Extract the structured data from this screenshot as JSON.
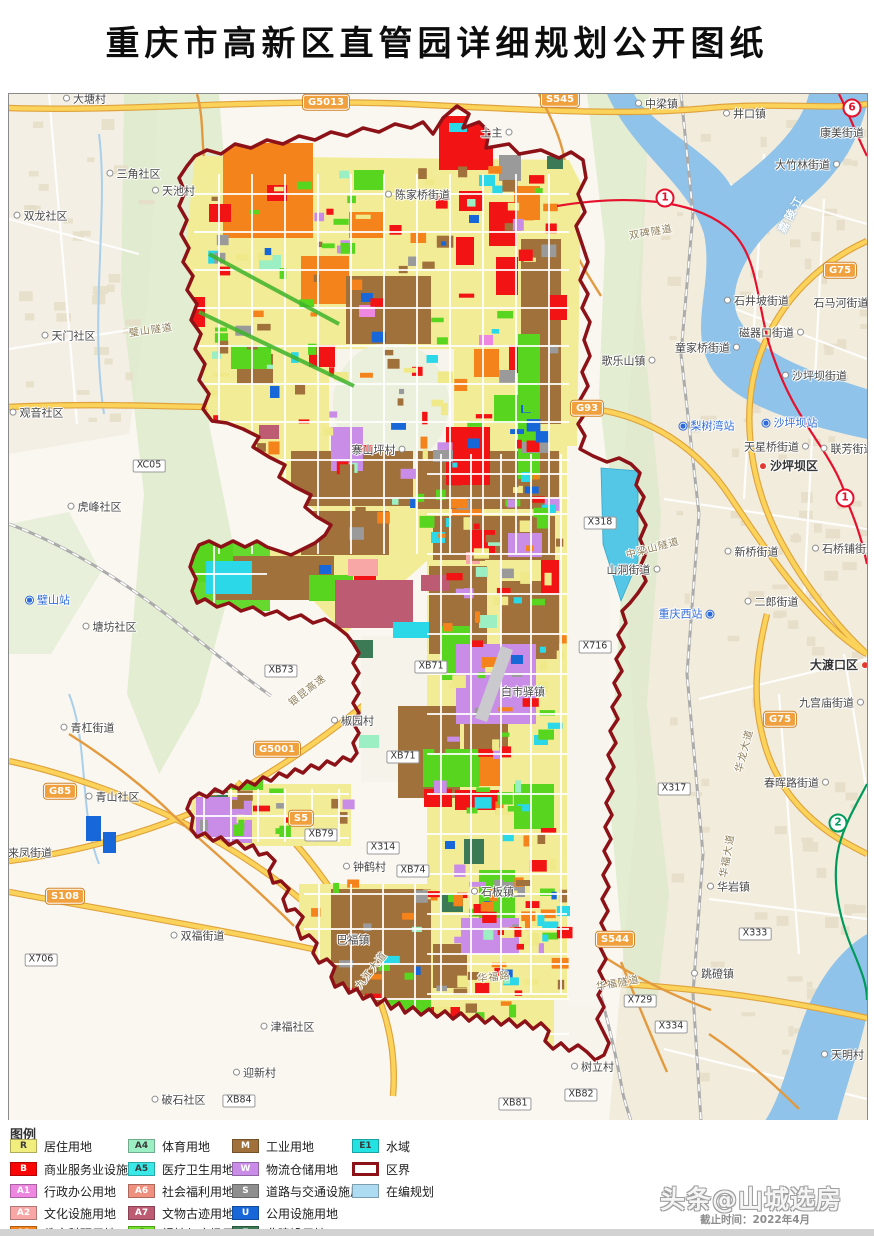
{
  "header": {
    "title": "重庆市高新区直管园详细规划公开图纸"
  },
  "watermark": {
    "line1": "头条@山城选房",
    "line2": "截止时间：2022年4月"
  },
  "legend": {
    "title": "图例",
    "columns": [
      [
        {
          "code": "R",
          "color": "#F1EE7D",
          "label": "居住用地"
        },
        {
          "code": "B",
          "color": "#FA0505",
          "label": "商业服务业设施用地"
        },
        {
          "code": "A1",
          "color": "#EE87E0",
          "label": "行政办公用地"
        },
        {
          "code": "A2",
          "color": "#F9A6A6",
          "label": "文化设施用地"
        },
        {
          "code": "A3",
          "color": "#F5831B",
          "label": "教育科研用地"
        }
      ],
      [
        {
          "code": "A4",
          "color": "#9BEFC3",
          "label": "体育用地"
        },
        {
          "code": "A5",
          "color": "#3BE8E8",
          "label": "医疗卫生用地"
        },
        {
          "code": "A6",
          "color": "#F0907E",
          "label": "社会福利用地"
        },
        {
          "code": "A7",
          "color": "#BC5B72",
          "label": "文物古迹用地"
        },
        {
          "code": "G",
          "color": "#6EE025",
          "label": "绿地与广场用地"
        }
      ],
      [
        {
          "code": "M",
          "color": "#A0713B",
          "label": "工业用地"
        },
        {
          "code": "W",
          "color": "#C98DE8",
          "label": "物流仓储用地"
        },
        {
          "code": "S",
          "color": "#8F8F8F",
          "label": "道路与交通设施用地"
        },
        {
          "code": "U",
          "color": "#1767D9",
          "label": "公用设施用地"
        },
        {
          "code": "E",
          "color": "#3C7A55",
          "label": "非建设用地"
        }
      ],
      [
        {
          "code": "E1",
          "color": "#25E2E2",
          "label": "水域"
        },
        {
          "code": "",
          "color": "#FFFFFF",
          "label": "区界",
          "type": "outline"
        },
        {
          "code": "",
          "color": "#ADDCF2",
          "label": "在编规划",
          "type": "plain"
        }
      ]
    ]
  },
  "map": {
    "boundary_color": "#8C1218",
    "places": [
      {
        "t": "大塘村",
        "x": 74,
        "y": 6,
        "m": "l"
      },
      {
        "t": "中梁镇",
        "x": 646,
        "y": 11,
        "m": "l"
      },
      {
        "t": "井口镇",
        "x": 734,
        "y": 21,
        "m": "l"
      },
      {
        "t": "康美街道",
        "x": 833,
        "y": 40,
        "m": "n"
      },
      {
        "t": "大竹林街道",
        "x": 800,
        "y": 72,
        "m": "r"
      },
      {
        "t": "三角社区",
        "x": 123,
        "y": 81,
        "m": "l"
      },
      {
        "t": "天池村",
        "x": 163,
        "y": 98,
        "m": "l"
      },
      {
        "t": "土主",
        "x": 489,
        "y": 40,
        "m": "r"
      },
      {
        "t": "双龙社区",
        "x": 30,
        "y": 123,
        "m": "l"
      },
      {
        "t": "陈家桥街道",
        "x": 407,
        "y": 102,
        "m": "l"
      },
      {
        "t": "石井坡街道",
        "x": 746,
        "y": 208,
        "m": "l"
      },
      {
        "t": "石马河街道",
        "x": 832,
        "y": 210,
        "m": "n"
      },
      {
        "t": "磁器口街道",
        "x": 764,
        "y": 240,
        "m": "r"
      },
      {
        "t": "童家桥街道",
        "x": 700,
        "y": 255,
        "m": "r"
      },
      {
        "t": "歌乐山镇",
        "x": 621,
        "y": 268,
        "m": "r"
      },
      {
        "t": "天门社区",
        "x": 58,
        "y": 243,
        "m": "l"
      },
      {
        "t": "观音社区",
        "x": 26,
        "y": 320,
        "m": "l"
      },
      {
        "t": "沙坪坝街道",
        "x": 804,
        "y": 283,
        "m": "l"
      },
      {
        "t": "天星桥街道",
        "x": 769,
        "y": 354,
        "m": "r"
      },
      {
        "t": "联芳街道",
        "x": 837,
        "y": 356,
        "m": "l"
      },
      {
        "t": "新桥街道",
        "x": 741,
        "y": 459,
        "m": "l"
      },
      {
        "t": "石桥铺街道",
        "x": 834,
        "y": 456,
        "m": "l"
      },
      {
        "t": "山洞街道",
        "x": 626,
        "y": 477,
        "m": "r"
      },
      {
        "t": "二郎街道",
        "x": 761,
        "y": 509,
        "m": "l"
      },
      {
        "t": "虎峰社区",
        "x": 84,
        "y": 414,
        "m": "l"
      },
      {
        "t": "塘坊社区",
        "x": 99,
        "y": 534,
        "m": "l"
      },
      {
        "t": "青杠街道",
        "x": 77,
        "y": 635,
        "m": "l"
      },
      {
        "t": "青山社区",
        "x": 102,
        "y": 704,
        "m": "l"
      },
      {
        "t": "来凤街道",
        "x": 21,
        "y": 760,
        "m": "n"
      },
      {
        "t": "双福街道",
        "x": 187,
        "y": 843,
        "m": "l"
      },
      {
        "t": "破石社区",
        "x": 168,
        "y": 1007,
        "m": "l"
      },
      {
        "t": "迎新村",
        "x": 244,
        "y": 980,
        "m": "l"
      },
      {
        "t": "津福社区",
        "x": 277,
        "y": 934,
        "m": "l"
      },
      {
        "t": "钟鹤村",
        "x": 354,
        "y": 774,
        "m": "l"
      },
      {
        "t": "椒园村",
        "x": 342,
        "y": 628,
        "m": "l"
      },
      {
        "t": "白市驿镇",
        "x": 514,
        "y": 599,
        "m": "n"
      },
      {
        "t": "石板镇",
        "x": 482,
        "y": 799,
        "m": "l"
      },
      {
        "t": "巴福镇",
        "x": 344,
        "y": 847,
        "m": "n"
      },
      {
        "t": "华岩镇",
        "x": 718,
        "y": 794,
        "m": "l"
      },
      {
        "t": "跳磴镇",
        "x": 702,
        "y": 881,
        "m": "l"
      },
      {
        "t": "树立村",
        "x": 582,
        "y": 974,
        "m": "l"
      },
      {
        "t": "天明村",
        "x": 832,
        "y": 962,
        "m": "l"
      },
      {
        "t": "九宫庙街道",
        "x": 824,
        "y": 610,
        "m": "r"
      },
      {
        "t": "春晖路街道",
        "x": 789,
        "y": 690,
        "m": "r"
      },
      {
        "t": "寨山坪村",
        "x": 371,
        "y": 357,
        "m": "r"
      }
    ],
    "districts": [
      {
        "t": "沙坪坝区",
        "x": 778,
        "y": 373,
        "m": "l"
      },
      {
        "t": "大渡口区",
        "x": 832,
        "y": 572,
        "m": "r"
      }
    ],
    "stations": [
      {
        "t": "璧山站",
        "x": 37,
        "y": 507,
        "i": "l"
      },
      {
        "t": "梨树湾站",
        "x": 696,
        "y": 333,
        "i": "l"
      },
      {
        "t": "沙坪坝站",
        "x": 779,
        "y": 330,
        "i": "l"
      },
      {
        "t": "重庆西站",
        "x": 679,
        "y": 521,
        "i": "r"
      }
    ],
    "roadcodes": [
      {
        "t": "XC05",
        "x": 140,
        "y": 372
      },
      {
        "t": "X318",
        "x": 591,
        "y": 429
      },
      {
        "t": "X716",
        "x": 586,
        "y": 553
      },
      {
        "t": "XB73",
        "x": 272,
        "y": 577
      },
      {
        "t": "XB71",
        "x": 422,
        "y": 573
      },
      {
        "t": "XB71",
        "x": 394,
        "y": 663
      },
      {
        "t": "X314",
        "x": 374,
        "y": 754
      },
      {
        "t": "XB79",
        "x": 312,
        "y": 741
      },
      {
        "t": "XB74",
        "x": 404,
        "y": 777
      },
      {
        "t": "X317",
        "x": 665,
        "y": 695
      },
      {
        "t": "X333",
        "x": 746,
        "y": 840
      },
      {
        "t": "X334",
        "x": 662,
        "y": 933
      },
      {
        "t": "X729",
        "x": 631,
        "y": 907
      },
      {
        "t": "XB81",
        "x": 506,
        "y": 1010
      },
      {
        "t": "XB82",
        "x": 572,
        "y": 1001
      },
      {
        "t": "XB84",
        "x": 230,
        "y": 1007
      },
      {
        "t": "X706",
        "x": 32,
        "y": 866
      }
    ],
    "shields": [
      {
        "t": "G5013",
        "x": 317,
        "y": 8
      },
      {
        "t": "S545",
        "x": 551,
        "y": 5
      },
      {
        "t": "G75",
        "x": 831,
        "y": 176
      },
      {
        "t": "G75",
        "x": 771,
        "y": 625
      },
      {
        "t": "G93",
        "x": 578,
        "y": 314
      },
      {
        "t": "G85",
        "x": 51,
        "y": 697
      },
      {
        "t": "G5001",
        "x": 268,
        "y": 655
      },
      {
        "t": "S5",
        "x": 292,
        "y": 724
      },
      {
        "t": "S108",
        "x": 56,
        "y": 802
      },
      {
        "t": "S544",
        "x": 606,
        "y": 845
      }
    ],
    "metro": [
      {
        "t": "1",
        "x": 656,
        "y": 104,
        "c": "#E5112D"
      },
      {
        "t": "1",
        "x": 836,
        "y": 404,
        "c": "#E5112D"
      },
      {
        "t": "6",
        "x": 843,
        "y": 14,
        "c": "#E5112D"
      },
      {
        "t": "2",
        "x": 829,
        "y": 729,
        "c": "#009B5B"
      }
    ],
    "roadnames": [
      {
        "t": "双碑隧道",
        "x": 642,
        "y": 139,
        "r": -10
      },
      {
        "t": "璧山隧道",
        "x": 142,
        "y": 237,
        "r": -8
      },
      {
        "t": "中梁山隧道",
        "x": 644,
        "y": 455,
        "r": -15
      },
      {
        "t": "银昆高速",
        "x": 299,
        "y": 597,
        "r": -38
      },
      {
        "t": "九江大道",
        "x": 363,
        "y": 877,
        "r": -52
      },
      {
        "t": "华福路",
        "x": 485,
        "y": 884,
        "r": -6
      },
      {
        "t": "华福隧道",
        "x": 609,
        "y": 890,
        "r": -10
      },
      {
        "t": "华龙大道",
        "x": 736,
        "y": 657,
        "r": -75
      },
      {
        "t": "华福大道",
        "x": 719,
        "y": 762,
        "r": -80
      }
    ],
    "waternames": [
      {
        "t": "嘉陵江",
        "x": 783,
        "y": 120,
        "r": -62
      }
    ]
  }
}
